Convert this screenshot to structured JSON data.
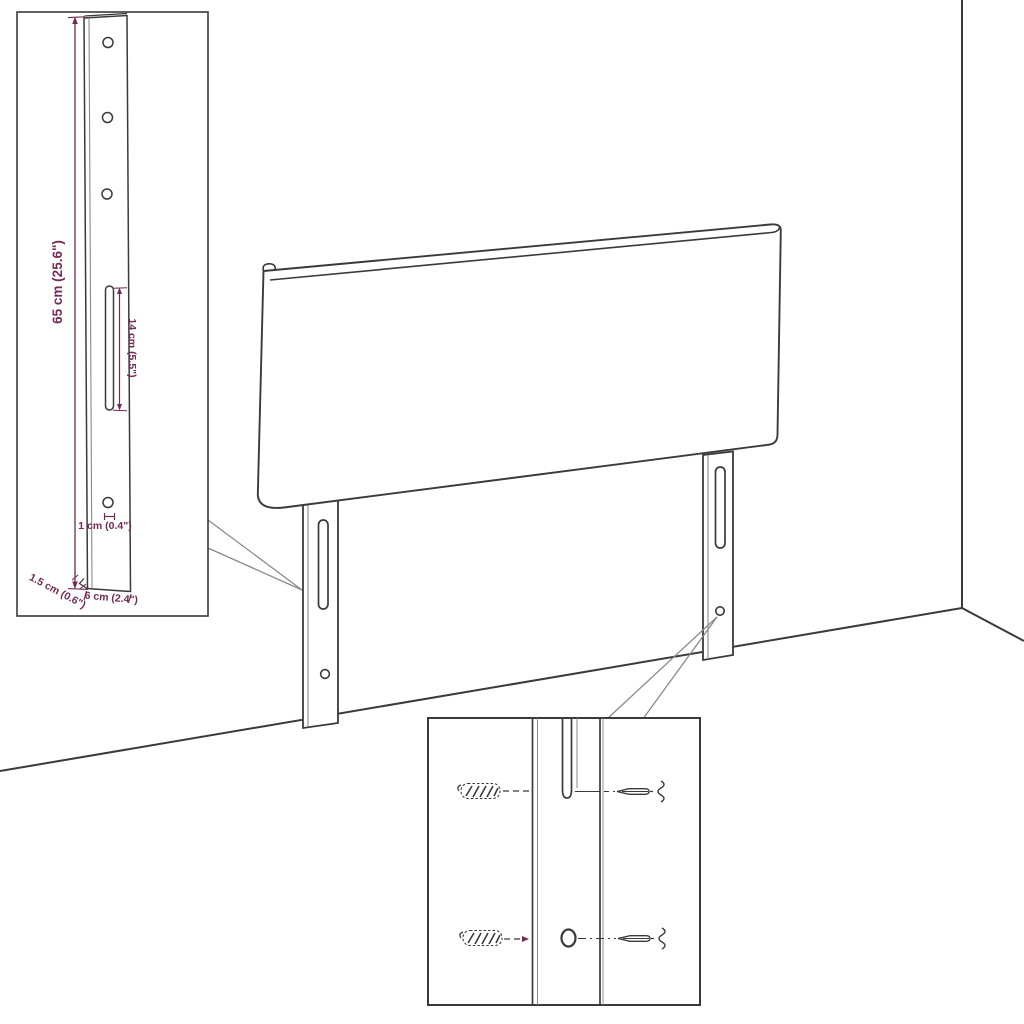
{
  "diagram": {
    "type": "product-assembly-technical-drawing",
    "subject": "headboard panel with two mounting legs shown in a room corner",
    "background_color": "#ffffff",
    "line_color": "#3a3a3a",
    "dimension_color": "#722a57",
    "leg_dimension_inset": {
      "description": "enlarged side view of one mounting leg with three screw holes, one slot and one lower hole",
      "dimensions": {
        "leg_height": "65 cm (25.6\")",
        "slot_length": "14 cm (5.5\")",
        "hole_diameter": "1 cm (0.4\")",
        "leg_thickness": "1.5 cm (0.6\")",
        "leg_width": "6 cm (2.4\")"
      }
    },
    "mounting_hardware_inset": {
      "description": "detail of leg slot and hole aligned with wall plugs (left) and screws (right)"
    }
  }
}
